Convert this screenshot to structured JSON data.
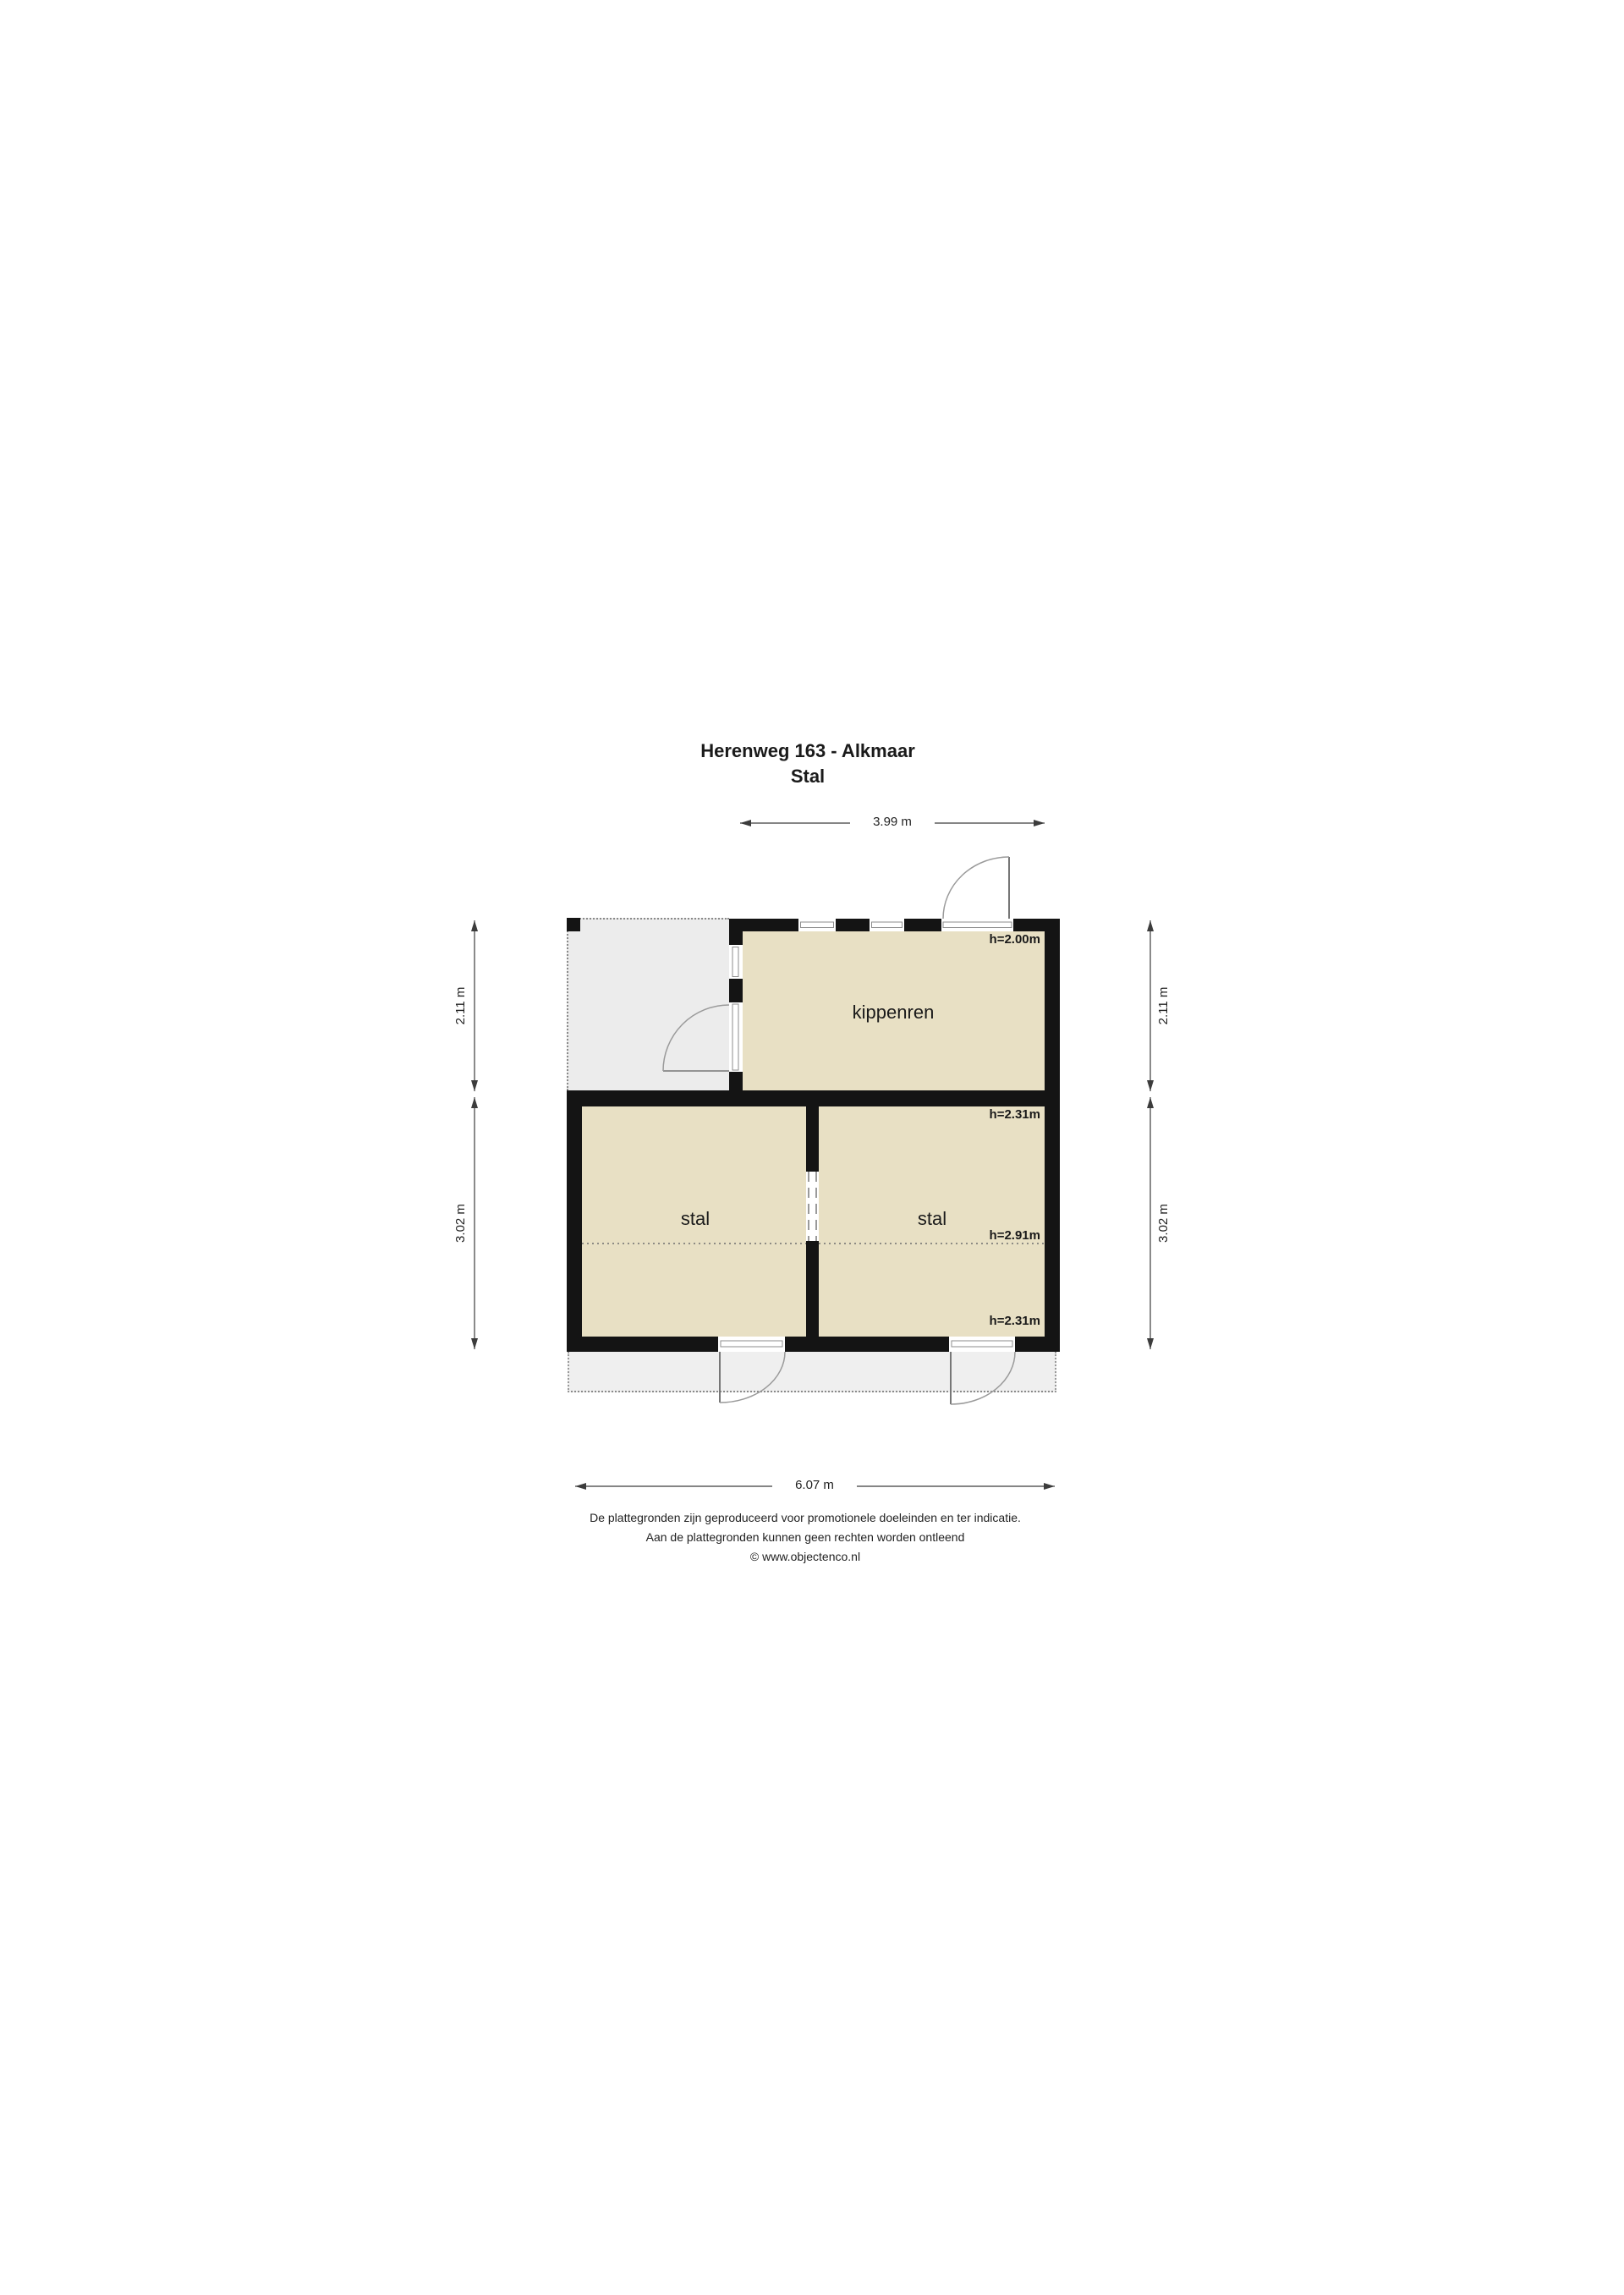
{
  "title": {
    "line1": "Herenweg 163 - Alkmaar",
    "line2": "Stal"
  },
  "dimensions": {
    "top_width": "3.99 m",
    "bottom_width": "6.07 m",
    "upper_height_left": "2.11 m",
    "lower_height_left": "3.02 m",
    "upper_height_right": "2.11 m",
    "lower_height_right": "3.02 m"
  },
  "rooms": {
    "kippenren": {
      "label": "kippenren",
      "ceiling_height": "h=2.00m"
    },
    "stal_left": {
      "label": "stal"
    },
    "stal_right": {
      "label": "stal",
      "ceiling_height_top": "h=2.31m",
      "ceiling_height_mid": "h=2.91m",
      "ceiling_height_bottom": "h=2.31m"
    }
  },
  "footer": {
    "line1": "De plattegronden zijn geproduceerd voor promotionele doeleinden en ter indicatie.",
    "line2": "Aan de plattegronden kunnen geen rechten worden ontleend",
    "line3": "© www.objectenco.nl"
  },
  "colors": {
    "room_fill": "#e8e0c4",
    "wall": "#141414",
    "open_area_fill": "#ececec",
    "apron_fill": "#efefef",
    "dotted_line": "#8a8a8a"
  }
}
